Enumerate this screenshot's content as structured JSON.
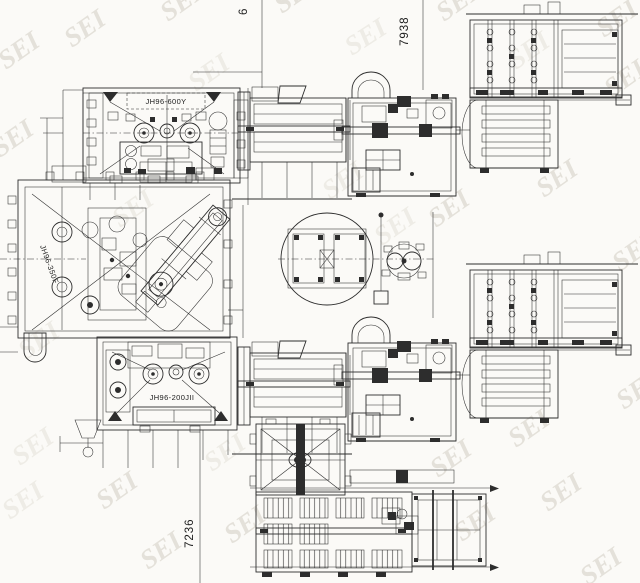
{
  "document": {
    "type": "machinery-plant-layout-plan",
    "watermark": {
      "text": "SEI"
    }
  },
  "dimension_labels": {
    "top_center_partial": "6",
    "top_right": "7938",
    "bottom": "7236"
  },
  "machine_labels": {
    "mill_top": "JH96-600Y",
    "mill_left": "JH96-350F",
    "mill_bottom": "JH96-200JII"
  },
  "colors": {
    "line": "#2d2d2d",
    "background": "#fbfaf7",
    "watermark": "#e4e1da"
  }
}
